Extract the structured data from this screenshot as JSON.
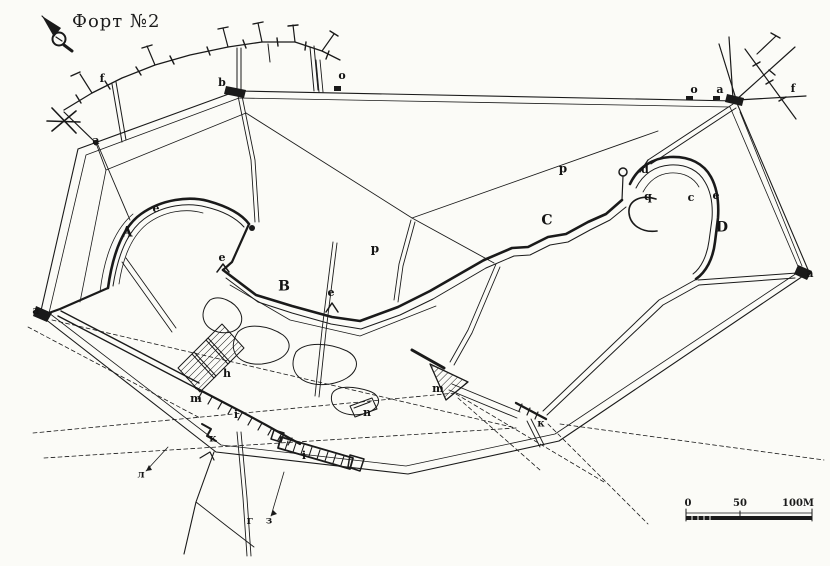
{
  "title": "Форт №2",
  "north_arrow": "compass-needle-icon",
  "scale_bar": {
    "t0": "0",
    "t1": "50",
    "t2": "100М"
  },
  "colors": {
    "ink": "#1a1a1a",
    "paper": "#fbfbf7"
  },
  "labels": [
    {
      "text": "A",
      "x": 127,
      "y": 233,
      "size": 14
    },
    {
      "text": "B",
      "x": 284,
      "y": 287,
      "size": 14
    },
    {
      "text": "C",
      "x": 547,
      "y": 221,
      "size": 14
    },
    {
      "text": "D",
      "x": 722,
      "y": 228,
      "size": 14
    },
    {
      "text": "a",
      "x": 96,
      "y": 141,
      "size": 11
    },
    {
      "text": "b",
      "x": 222,
      "y": 83,
      "size": 11
    },
    {
      "text": "o",
      "x": 342,
      "y": 76,
      "size": 11
    },
    {
      "text": "o",
      "x": 694,
      "y": 90,
      "size": 11
    },
    {
      "text": "a",
      "x": 720,
      "y": 90,
      "size": 11
    },
    {
      "text": "f",
      "x": 793,
      "y": 89,
      "size": 11
    },
    {
      "text": "f",
      "x": 102,
      "y": 79,
      "size": 11
    },
    {
      "text": "a",
      "x": 36,
      "y": 311,
      "size": 11
    },
    {
      "text": "a",
      "x": 810,
      "y": 274,
      "size": 11
    },
    {
      "text": "e",
      "x": 156,
      "y": 209,
      "size": 11
    },
    {
      "text": "e",
      "x": 222,
      "y": 258,
      "size": 11
    },
    {
      "text": "e",
      "x": 331,
      "y": 293,
      "size": 11
    },
    {
      "text": "e",
      "x": 716,
      "y": 196,
      "size": 11
    },
    {
      "text": "c",
      "x": 691,
      "y": 198,
      "size": 11
    },
    {
      "text": "d",
      "x": 645,
      "y": 170,
      "size": 11
    },
    {
      "text": "q",
      "x": 648,
      "y": 197,
      "size": 11
    },
    {
      "text": "p",
      "x": 563,
      "y": 169,
      "size": 12
    },
    {
      "text": "p",
      "x": 375,
      "y": 249,
      "size": 12
    },
    {
      "text": "h",
      "x": 227,
      "y": 374,
      "size": 11
    },
    {
      "text": "m",
      "x": 196,
      "y": 399,
      "size": 11
    },
    {
      "text": "i",
      "x": 236,
      "y": 415,
      "size": 11
    },
    {
      "text": "к",
      "x": 213,
      "y": 440,
      "size": 10
    },
    {
      "text": "m",
      "x": 438,
      "y": 389,
      "size": 11
    },
    {
      "text": "к",
      "x": 541,
      "y": 425,
      "size": 10
    },
    {
      "text": "n",
      "x": 367,
      "y": 413,
      "size": 11
    },
    {
      "text": "i",
      "x": 304,
      "y": 456,
      "size": 11
    },
    {
      "text": "г",
      "x": 250,
      "y": 521,
      "size": 11
    },
    {
      "text": "з",
      "x": 269,
      "y": 522,
      "size": 10
    },
    {
      "text": "л",
      "x": 141,
      "y": 476,
      "size": 10
    }
  ]
}
